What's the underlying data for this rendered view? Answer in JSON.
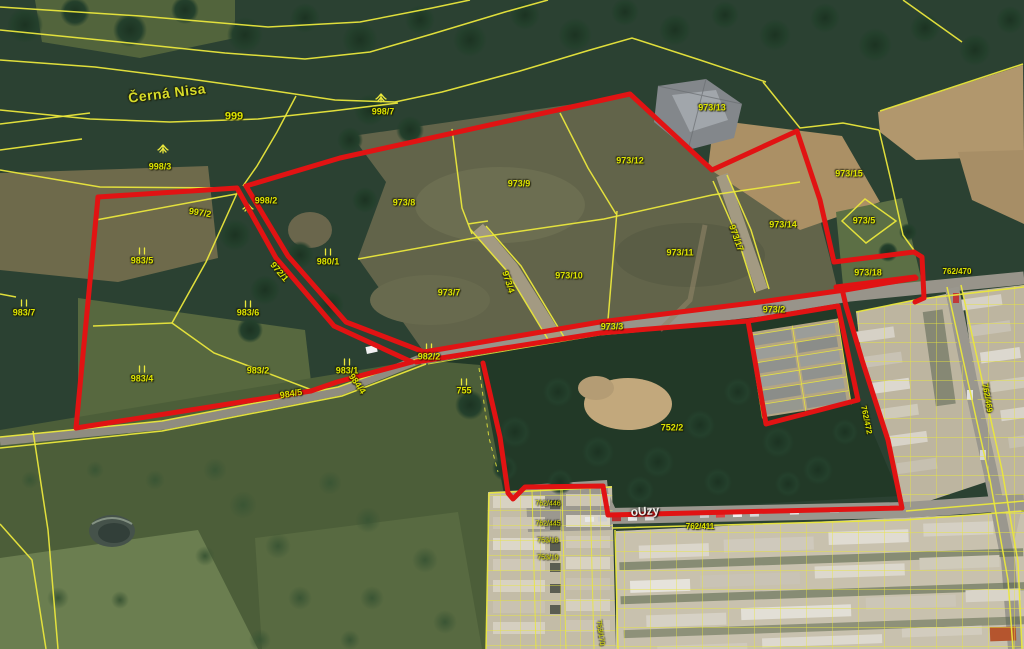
{
  "map": {
    "type": "cadastral-orthophoto",
    "watercourse_label": "Černá Nisa",
    "street_label": "oUzy",
    "colors": {
      "highlight_red": "#e11313",
      "parcel_yellow": "#eae73c",
      "label_olive": "#dde400",
      "street_white": "#f0f0ea"
    },
    "labels": [
      {
        "text": "Černá Nisa",
        "x": 167,
        "y": 93,
        "rot": -7,
        "cls": "stream",
        "name": "stream-label"
      },
      {
        "text": "999",
        "x": 234,
        "y": 117,
        "cls": "big",
        "name": "parcel-label"
      },
      {
        "text": "998/7",
        "x": 383,
        "y": 112,
        "cls": "",
        "name": "parcel-label"
      },
      {
        "text": "998/3",
        "x": 160,
        "y": 167,
        "cls": "",
        "name": "parcel-label"
      },
      {
        "text": "998/2",
        "x": 266,
        "y": 201,
        "cls": "",
        "name": "parcel-label"
      },
      {
        "text": "997/2",
        "x": 200,
        "y": 213,
        "rot": 9,
        "cls": "",
        "name": "parcel-label"
      },
      {
        "text": "972/1",
        "x": 279,
        "y": 272,
        "rot": 50,
        "cls": "",
        "name": "parcel-label"
      },
      {
        "text": "980/1",
        "x": 328,
        "y": 262,
        "cls": "",
        "name": "parcel-label"
      },
      {
        "text": "983/5",
        "x": 142,
        "y": 261,
        "cls": "",
        "name": "parcel-label"
      },
      {
        "text": "983/6",
        "x": 248,
        "y": 313,
        "cls": "",
        "name": "parcel-label"
      },
      {
        "text": "983/7",
        "x": 24,
        "y": 313,
        "cls": "",
        "name": "parcel-label"
      },
      {
        "text": "983/4",
        "x": 142,
        "y": 379,
        "cls": "",
        "name": "parcel-label"
      },
      {
        "text": "983/2",
        "x": 258,
        "y": 371,
        "cls": "",
        "name": "parcel-label"
      },
      {
        "text": "983/1",
        "x": 347,
        "y": 371,
        "cls": "",
        "name": "parcel-label"
      },
      {
        "text": "982/2",
        "x": 429,
        "y": 357,
        "cls": "",
        "name": "parcel-label"
      },
      {
        "text": "755",
        "x": 464,
        "y": 391,
        "cls": "",
        "name": "parcel-label"
      },
      {
        "text": "984/5",
        "x": 291,
        "y": 394,
        "rot": -9,
        "cls": "",
        "name": "parcel-label"
      },
      {
        "text": "984/4",
        "x": 357,
        "y": 384,
        "rot": 55,
        "cls": "",
        "name": "parcel-label"
      },
      {
        "text": "973/8",
        "x": 404,
        "y": 203,
        "cls": "",
        "name": "parcel-label"
      },
      {
        "text": "973/9",
        "x": 519,
        "y": 184,
        "cls": "",
        "name": "parcel-label"
      },
      {
        "text": "973/12",
        "x": 630,
        "y": 161,
        "cls": "",
        "name": "parcel-label"
      },
      {
        "text": "973/13",
        "x": 712,
        "y": 108,
        "cls": "",
        "name": "parcel-label"
      },
      {
        "text": "973/7",
        "x": 449,
        "y": 293,
        "cls": "",
        "name": "parcel-label"
      },
      {
        "text": "973/4",
        "x": 508,
        "y": 282,
        "rot": 72,
        "cls": "",
        "name": "parcel-label"
      },
      {
        "text": "973/10",
        "x": 569,
        "y": 276,
        "cls": "",
        "name": "parcel-label"
      },
      {
        "text": "973/11",
        "x": 680,
        "y": 253,
        "cls": "",
        "name": "parcel-label"
      },
      {
        "text": "973/17",
        "x": 736,
        "y": 238,
        "rot": 70,
        "cls": "",
        "name": "parcel-label"
      },
      {
        "text": "973/14",
        "x": 783,
        "y": 225,
        "cls": "",
        "name": "parcel-label"
      },
      {
        "text": "973/15",
        "x": 849,
        "y": 174,
        "cls": "",
        "name": "parcel-label"
      },
      {
        "text": "973/5",
        "x": 864,
        "y": 221,
        "cls": "",
        "name": "parcel-label"
      },
      {
        "text": "973/18",
        "x": 868,
        "y": 273,
        "cls": "",
        "name": "parcel-label"
      },
      {
        "text": "973/3",
        "x": 612,
        "y": 327,
        "cls": "",
        "name": "parcel-label"
      },
      {
        "text": "973/2",
        "x": 774,
        "y": 310,
        "cls": "",
        "name": "parcel-label"
      },
      {
        "text": "752/2",
        "x": 672,
        "y": 428,
        "cls": "",
        "name": "parcel-label"
      },
      {
        "text": "oUzy",
        "x": 645,
        "y": 511,
        "rot": -4,
        "cls": "street",
        "name": "street-label"
      },
      {
        "text": "762/411",
        "x": 700,
        "y": 527,
        "cls": "small",
        "name": "parcel-label"
      },
      {
        "text": "762/470",
        "x": 957,
        "y": 272,
        "cls": "small",
        "name": "parcel-label"
      },
      {
        "text": "762/472",
        "x": 866,
        "y": 420,
        "rot": 78,
        "cls": "small",
        "name": "parcel-label"
      },
      {
        "text": "762/469",
        "x": 987,
        "y": 398,
        "rot": 80,
        "cls": "small",
        "name": "parcel-label"
      },
      {
        "text": "762/446",
        "x": 548,
        "y": 504,
        "cls": "tiny",
        "name": "parcel-label"
      },
      {
        "text": "762/445",
        "x": 548,
        "y": 524,
        "cls": "tiny",
        "name": "parcel-label"
      },
      {
        "text": "753/18",
        "x": 548,
        "y": 541,
        "cls": "tiny",
        "name": "parcel-label"
      },
      {
        "text": "753/19",
        "x": 548,
        "y": 558,
        "cls": "tiny",
        "name": "parcel-label"
      },
      {
        "text": "753/170",
        "x": 600,
        "y": 633,
        "rot": 82,
        "cls": "tiny",
        "name": "parcel-label"
      }
    ],
    "symbols": [
      {
        "type": "tree",
        "x": 163,
        "y": 147
      },
      {
        "type": "tree",
        "x": 381,
        "y": 96
      },
      {
        "type": "tree",
        "x": 248,
        "y": 206
      },
      {
        "type": "grass",
        "x": 142,
        "y": 251
      },
      {
        "type": "grass",
        "x": 248,
        "y": 304
      },
      {
        "type": "grass",
        "x": 24,
        "y": 303
      },
      {
        "type": "grass",
        "x": 142,
        "y": 369
      },
      {
        "type": "grass",
        "x": 328,
        "y": 252
      },
      {
        "type": "grass",
        "x": 347,
        "y": 362
      },
      {
        "type": "grass",
        "x": 429,
        "y": 347
      },
      {
        "type": "grass",
        "x": 464,
        "y": 382
      }
    ]
  }
}
